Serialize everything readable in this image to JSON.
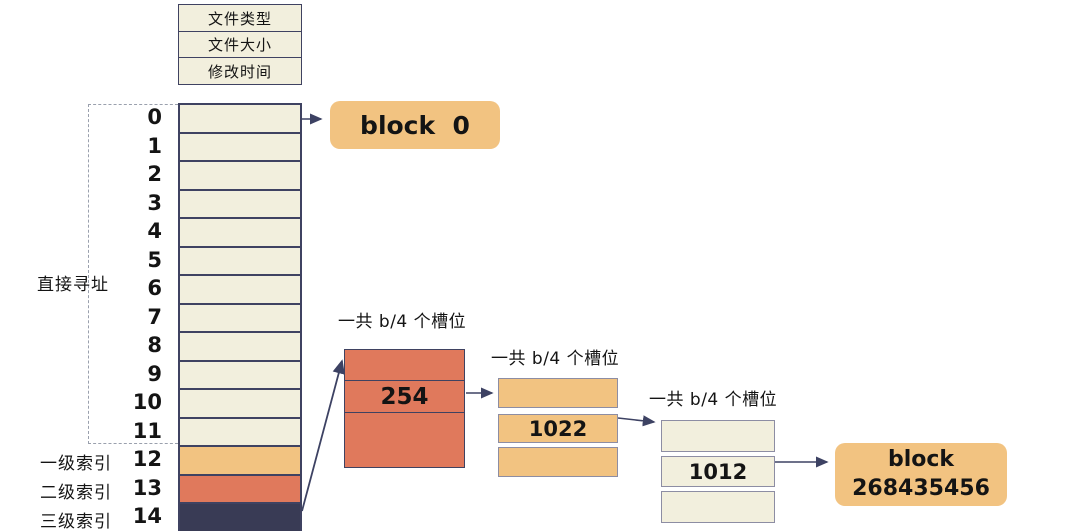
{
  "inode": {
    "meta_fields": [
      "文件类型",
      "文件大小",
      "修改时间"
    ],
    "row_numbers": [
      "0",
      "1",
      "2",
      "3",
      "4",
      "5",
      "6",
      "7",
      "8",
      "9",
      "10",
      "11",
      "12",
      "13",
      "14"
    ],
    "labels": {
      "direct": "直接寻址",
      "single_indirect": "一级索引",
      "double_indirect": "二级索引",
      "triple_indirect": "三级索引"
    }
  },
  "blocks": {
    "block0_label": "block  0",
    "final_block_line1": "block",
    "final_block_line2": "268435456"
  },
  "indirect_tables": {
    "slots_caption": "一共 b/4 个槽位",
    "level1": {
      "slots": [
        "",
        "254",
        ""
      ]
    },
    "level2": {
      "slots": [
        "",
        "1022",
        ""
      ]
    },
    "level3": {
      "slots": [
        "",
        "1012",
        ""
      ]
    }
  },
  "colors": {
    "cream": "#f2efdd",
    "orange": "#f2c381",
    "salmon": "#e0795c",
    "navy_fill": "#393b55",
    "border_navy": "#3f4261",
    "border_gray": "#8d8da3",
    "dash_gray": "#9aa0ad",
    "arrow": "#3d4263"
  }
}
